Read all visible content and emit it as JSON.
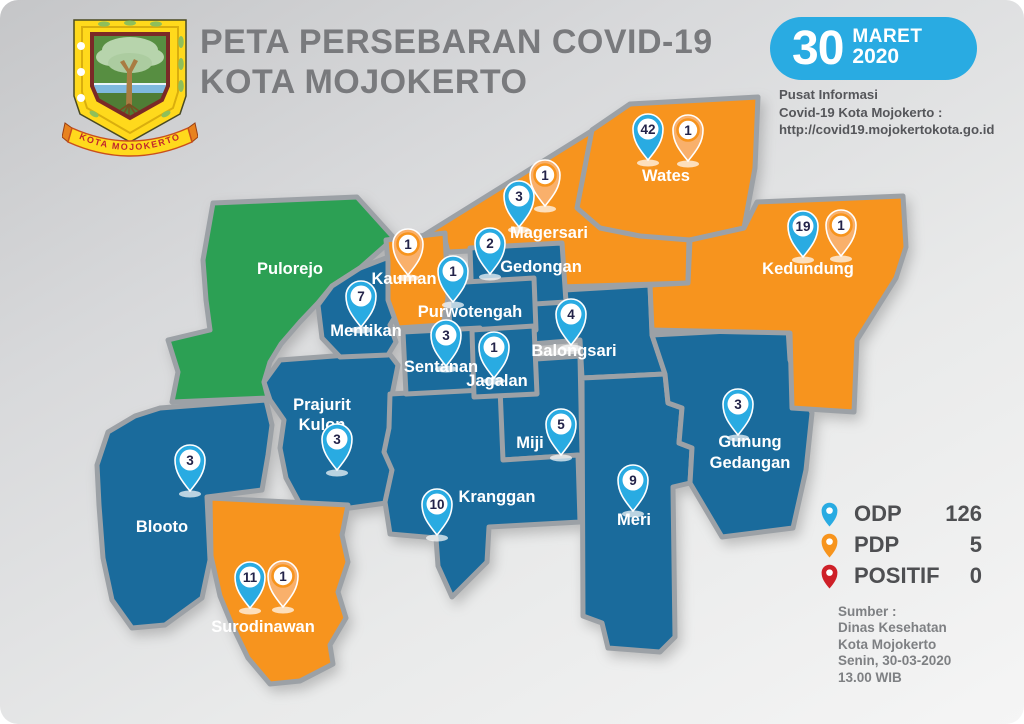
{
  "page": {
    "title_line1": "PETA PERSEBARAN COVID-19",
    "title_line2": "KOTA MOJOKERTO"
  },
  "logo": {
    "banner_text": "KOTA MOJOKERTO"
  },
  "date_badge": {
    "day": "30",
    "month": "MARET",
    "year": "2020"
  },
  "info_panel": {
    "line1": "Pusat Informasi",
    "line2": "Covid-19 Kota Mojokerto :",
    "line3": "http://covid19.mojokertokota.go.id"
  },
  "legend": {
    "items": [
      {
        "label": "ODP",
        "value": "126",
        "type": "odp"
      },
      {
        "label": "PDP",
        "value": "5",
        "type": "pdp"
      },
      {
        "label": "POSITIF",
        "value": "0",
        "type": "positif"
      }
    ]
  },
  "source_panel": {
    "lines": [
      "Sumber :",
      "Dinas Kesehatan",
      "Kota Mojokerto",
      "Senin, 30-03-2020",
      "13.00 WIB"
    ]
  },
  "colors": {
    "blue": "#1A6B9C",
    "orange": "#F7941E",
    "green": "#2CA054",
    "border": "#9CA1A6",
    "badge": "#29ABE2",
    "odp": "#29ABE2",
    "pdp": "#F7941D",
    "positif": "#CE2028",
    "title": "#797A7D",
    "text-dark": "#55565A",
    "text-gray": "#7E8083"
  },
  "districts": [
    {
      "name": "Pulorejo",
      "color": "green",
      "label_lines": [
        "Pulorejo"
      ],
      "pins": []
    },
    {
      "name": "Kauman",
      "color": "orange",
      "label_lines": [
        "Kauman"
      ],
      "pins": [
        {
          "type": "pdp",
          "count": 1
        }
      ]
    },
    {
      "name": "Magersari",
      "color": "orange",
      "label_lines": [
        "Magersari"
      ],
      "pins": [
        {
          "type": "odp",
          "count": 3
        },
        {
          "type": "pdp",
          "count": 1
        }
      ]
    },
    {
      "name": "Wates",
      "color": "orange",
      "label_lines": [
        "Wates"
      ],
      "pins": [
        {
          "type": "odp",
          "count": 42
        },
        {
          "type": "pdp",
          "count": 1
        }
      ]
    },
    {
      "name": "Kedundung",
      "color": "orange",
      "label_lines": [
        "Kedundung"
      ],
      "pins": [
        {
          "type": "odp",
          "count": 19
        },
        {
          "type": "pdp",
          "count": 1
        }
      ]
    },
    {
      "name": "Gedongan",
      "color": "blue",
      "label_lines": [
        "Gedongan"
      ],
      "pins": [
        {
          "type": "odp",
          "count": 2
        }
      ]
    },
    {
      "name": "Purwotengah",
      "color": "blue",
      "label_lines": [
        "Purwotengah"
      ],
      "pins": [
        {
          "type": "odp",
          "count": 1
        }
      ]
    },
    {
      "name": "Mentikan",
      "color": "blue",
      "label_lines": [
        "Mentikan"
      ],
      "pins": [
        {
          "type": "odp",
          "count": 7
        }
      ]
    },
    {
      "name": "Sentanan",
      "color": "blue",
      "label_lines": [
        "Sentanan"
      ],
      "pins": [
        {
          "type": "odp",
          "count": 3
        }
      ]
    },
    {
      "name": "Jagalan",
      "color": "blue",
      "label_lines": [
        "Jagalan"
      ],
      "pins": [
        {
          "type": "odp",
          "count": 1
        }
      ]
    },
    {
      "name": "Balongsari",
      "color": "blue",
      "label_lines": [
        "Balongsari"
      ],
      "pins": [
        {
          "type": "odp",
          "count": 4
        }
      ]
    },
    {
      "name": "Prajurit Kulon",
      "color": "blue",
      "label_lines": [
        "Prajurit",
        "Kulon"
      ],
      "pins": [
        {
          "type": "odp",
          "count": 3
        }
      ]
    },
    {
      "name": "Miji",
      "color": "blue",
      "label_lines": [
        "Miji"
      ],
      "pins": [
        {
          "type": "odp",
          "count": 5
        }
      ]
    },
    {
      "name": "Blooto",
      "color": "blue",
      "label_lines": [
        "Blooto"
      ],
      "pins": [
        {
          "type": "odp",
          "count": 3
        }
      ]
    },
    {
      "name": "Kranggan",
      "color": "blue",
      "label_lines": [
        "Kranggan"
      ],
      "pins": [
        {
          "type": "odp",
          "count": 10
        }
      ]
    },
    {
      "name": "Meri",
      "color": "blue",
      "label_lines": [
        "Meri"
      ],
      "pins": [
        {
          "type": "odp",
          "count": 9
        }
      ]
    },
    {
      "name": "Gunung Gedangan",
      "color": "blue",
      "label_lines": [
        "Gunung",
        "Gedangan"
      ],
      "pins": [
        {
          "type": "odp",
          "count": 3
        }
      ]
    },
    {
      "name": "Surodinawan",
      "color": "orange",
      "label_lines": [
        "Surodinawan"
      ],
      "pins": [
        {
          "type": "odp",
          "count": 11
        },
        {
          "type": "pdp",
          "count": 1
        }
      ]
    }
  ]
}
